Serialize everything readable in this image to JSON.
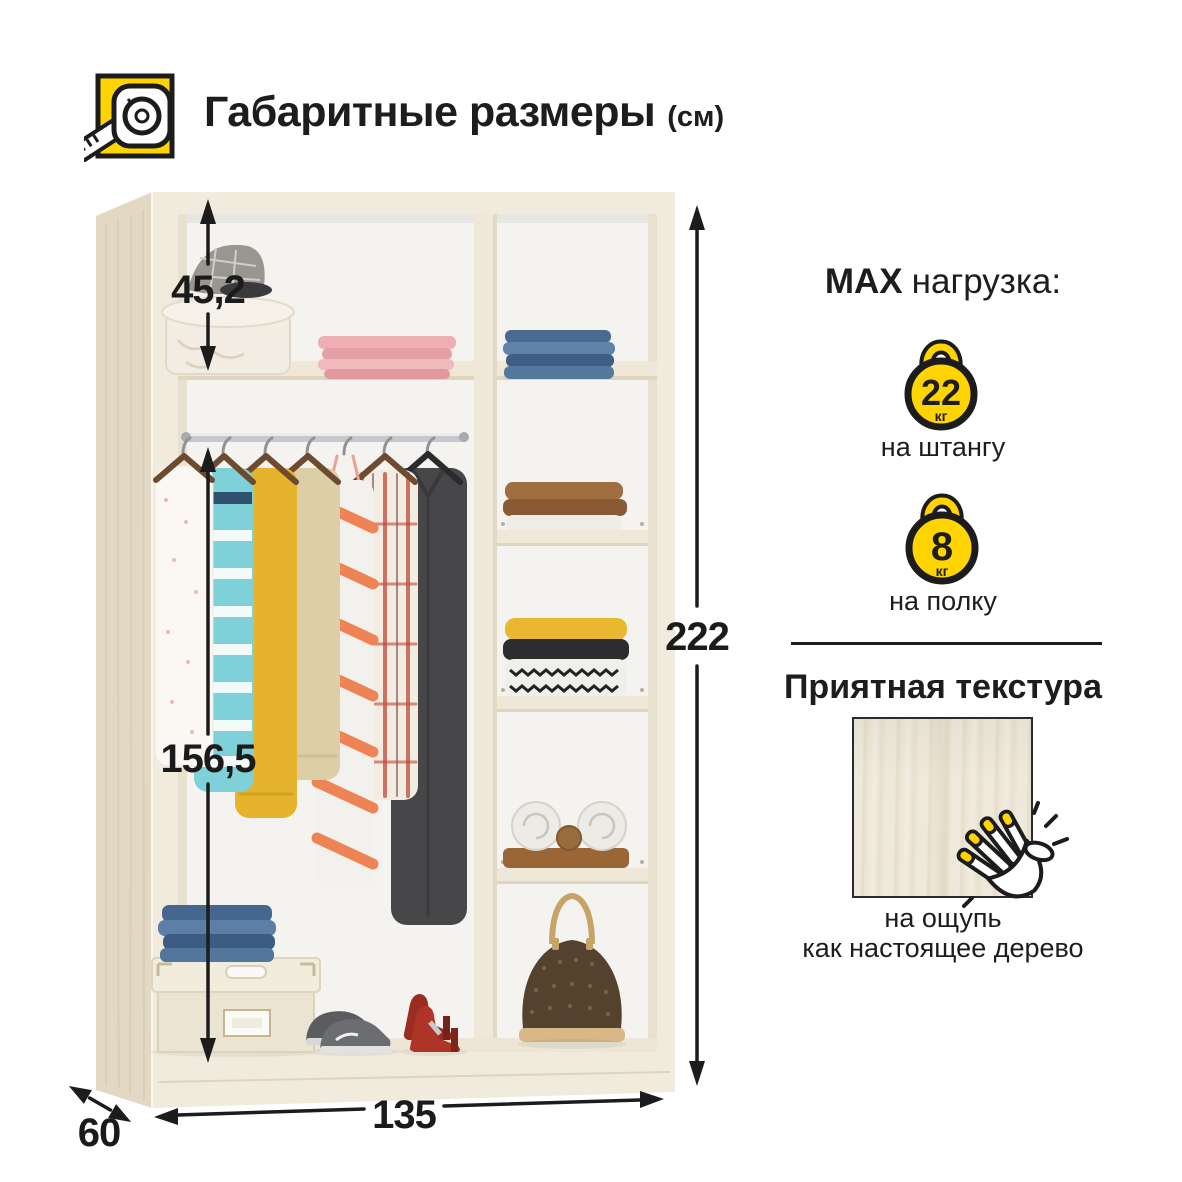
{
  "header": {
    "title": "Габаритные размеры",
    "unit": "(см)"
  },
  "wardrobe": {
    "dimensions": {
      "top_shelf_height": "45,2",
      "hanging_height": "156,5",
      "total_height": "222",
      "width": "135",
      "depth": "60"
    }
  },
  "load": {
    "heading_max": "MAX",
    "heading_rest": "нагрузка:",
    "items": [
      {
        "weight": "22",
        "unit": "кг",
        "label": "на штангу"
      },
      {
        "weight": "8",
        "unit": "кг",
        "label": "на полку"
      }
    ]
  },
  "texture": {
    "heading": "Приятная текстура",
    "caption_line1": "на ощупь",
    "caption_line2": "как настоящее дерево"
  },
  "icons": {
    "header": "tape-measure-icon",
    "load": "kettlebell-icon",
    "texture": "clap-hand-icon"
  },
  "colors": {
    "accent_yellow": "#FFD400",
    "text_black": "#1D1D1D",
    "wood_front": "#F1EBDE",
    "wood_side": "#E2D8C4",
    "interior": "#F4F3F0"
  }
}
